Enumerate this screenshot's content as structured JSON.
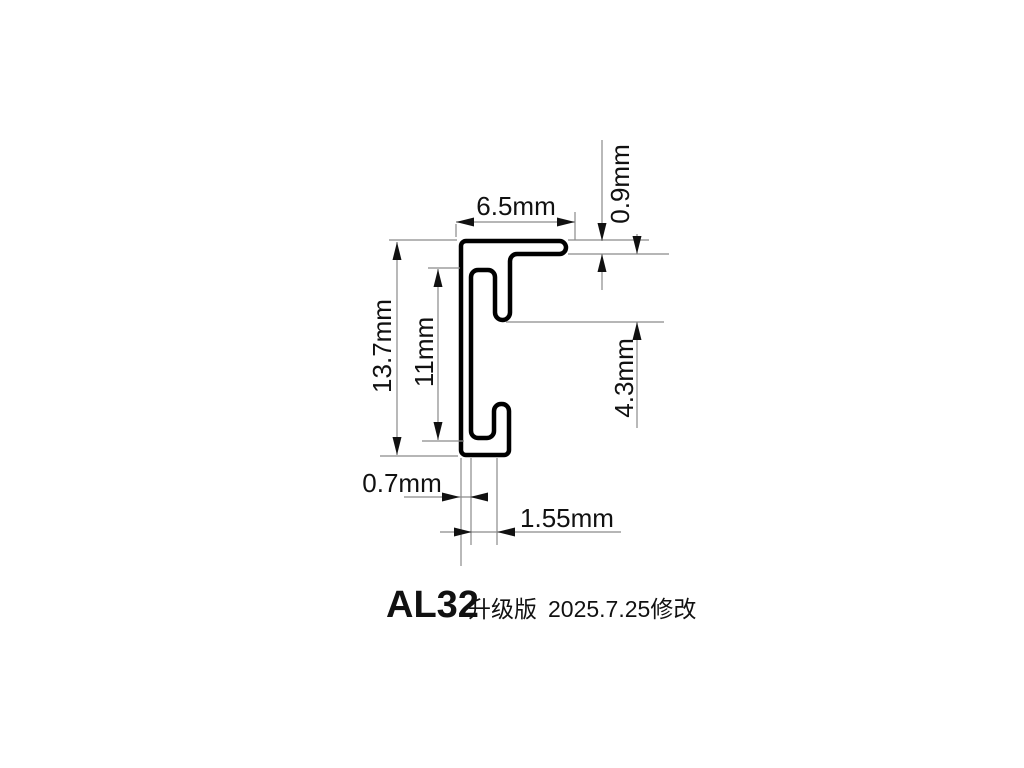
{
  "drawing": {
    "type": "profile-cross-section",
    "part_name": "AL32",
    "units": "mm"
  },
  "dimensions": {
    "top_width": "6.5mm",
    "top_flange_thickness": "0.9mm",
    "overall_height": "13.7mm",
    "inner_height": "11mm",
    "right_depth": "4.3mm",
    "wall_thickness": "0.7mm",
    "bottom_slot_width": "1.55mm"
  },
  "title": {
    "model": "AL32",
    "edition": "升级版",
    "revision": "2025.7.25修改"
  },
  "colors": {
    "background": "#ffffff",
    "profile_outline": "#000000",
    "dimension_lines": "#8a8a8a",
    "text": "#111111"
  }
}
